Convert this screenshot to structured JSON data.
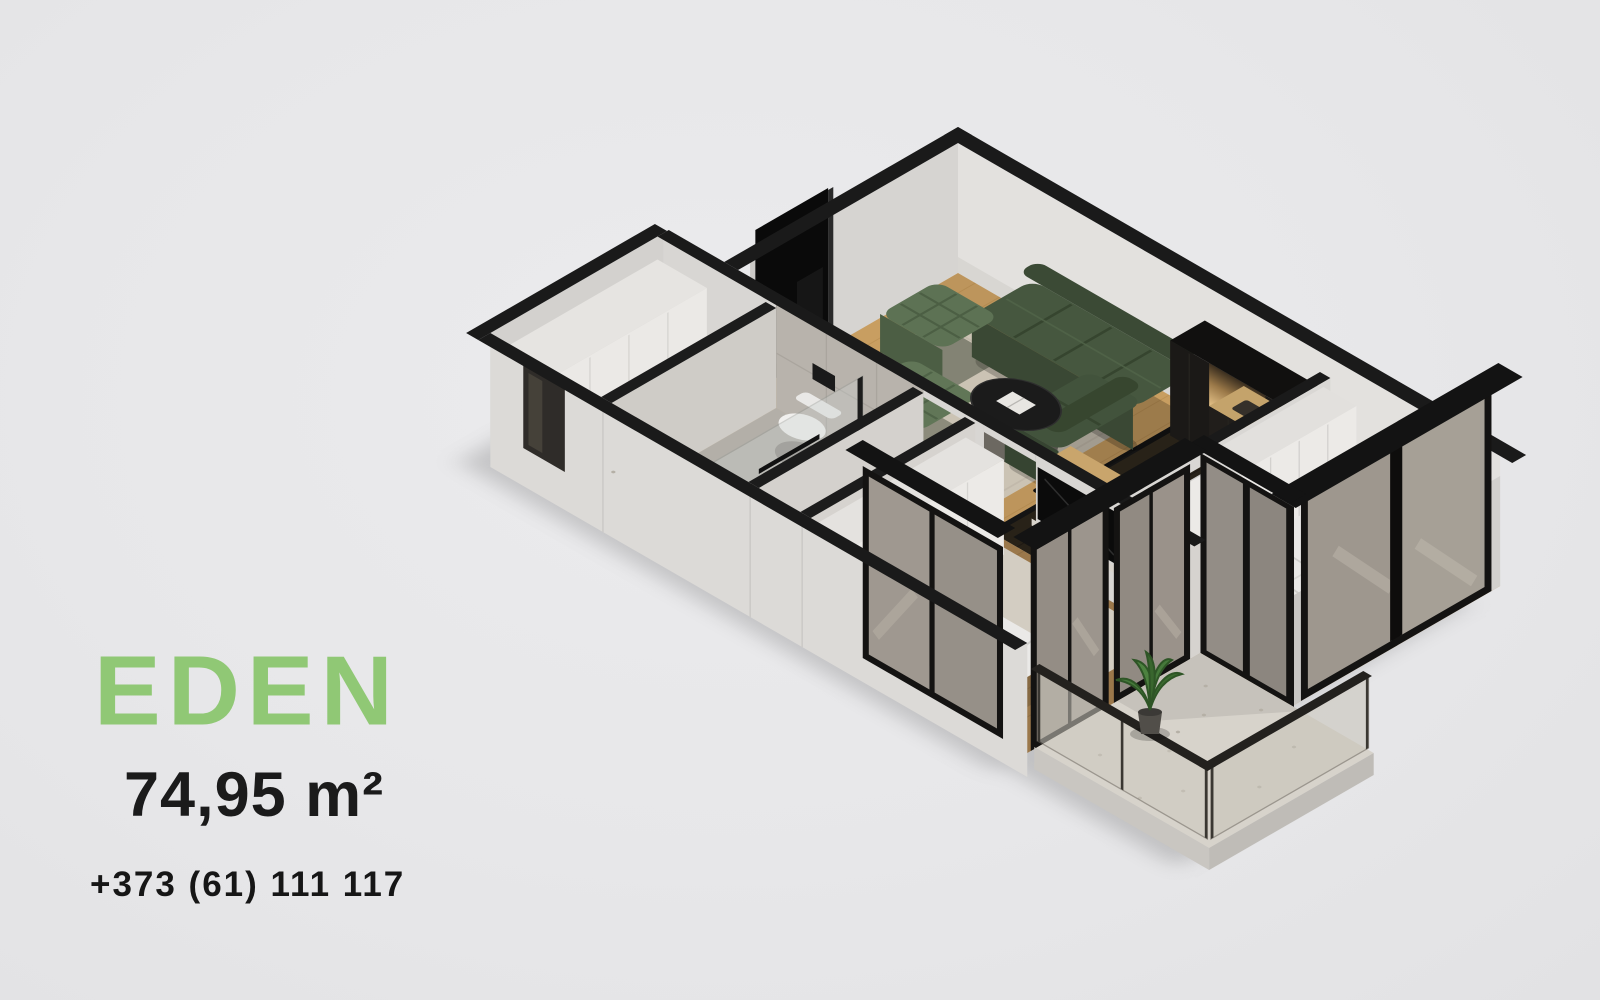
{
  "page": {
    "background_color": "#e7e7e9"
  },
  "branding": {
    "name": "EDEN",
    "accent_color": "#90c875"
  },
  "listing": {
    "area_label": "74,95 m²",
    "phone": "+373 (61) 111 117"
  },
  "floor_plan": {
    "alt": "Isometric 3D cutaway render of apartment EDEN",
    "rooms": [
      "living room",
      "kitchen",
      "bedroom",
      "second bedroom",
      "bathroom",
      "hallway",
      "entry",
      "balcony"
    ]
  }
}
